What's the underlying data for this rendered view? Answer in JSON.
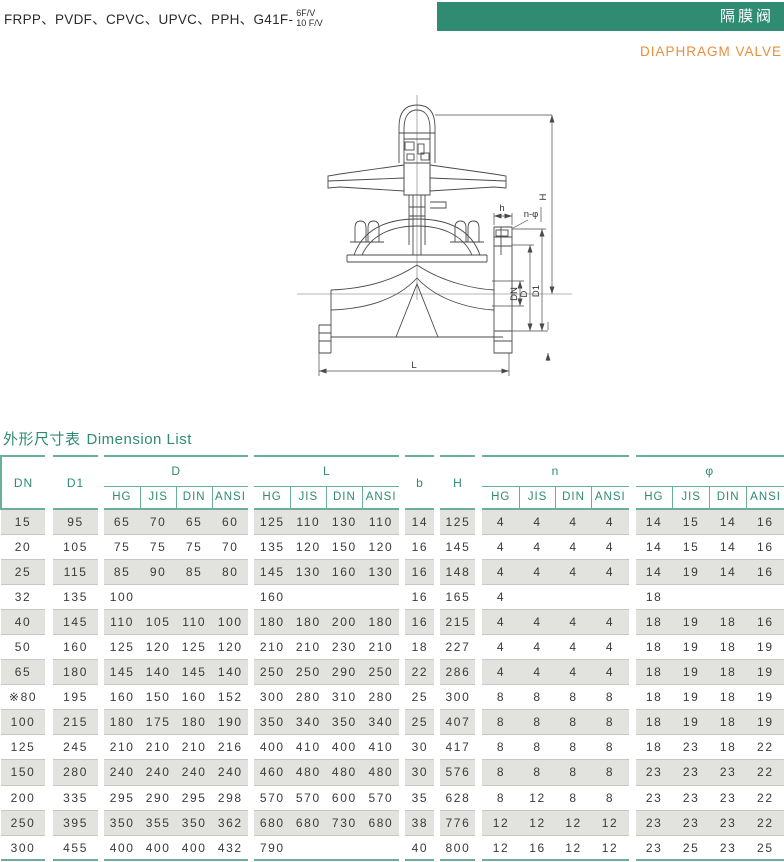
{
  "header": {
    "materials": "FRPP、PVDF、CPVC、UPVC、PPH、G41F-",
    "model_top": "6F/V",
    "model_bottom": "10 F/V",
    "banner_cn": "隔膜阀",
    "banner_en": "DIAPHRAGM VALVE"
  },
  "diagram": {
    "labels": {
      "H": "H",
      "h": "h",
      "n_phi": "n-φ",
      "DN": "DN",
      "D": "D",
      "D1": "D1",
      "L": "L"
    }
  },
  "section": {
    "title_cn": "外形尺寸表",
    "title_en": "Dimension List"
  },
  "table": {
    "standards": [
      "HG",
      "JIS",
      "DIN",
      "ANSI"
    ],
    "columns": {
      "dn": "DN",
      "d1": "D1",
      "d": "D",
      "l": "L",
      "b": "b",
      "h": "H",
      "n": "n",
      "phi": "φ"
    },
    "rows": [
      {
        "dn": "15",
        "d1": "95",
        "d": [
          "65",
          "70",
          "65",
          "60"
        ],
        "l": [
          "125",
          "110",
          "130",
          "110"
        ],
        "b": "14",
        "h": "125",
        "n": [
          "4",
          "4",
          "4",
          "4"
        ],
        "phi": [
          "14",
          "15",
          "14",
          "16"
        ]
      },
      {
        "dn": "20",
        "d1": "105",
        "d": [
          "75",
          "75",
          "75",
          "70"
        ],
        "l": [
          "135",
          "120",
          "150",
          "120"
        ],
        "b": "16",
        "h": "145",
        "n": [
          "4",
          "4",
          "4",
          "4"
        ],
        "phi": [
          "14",
          "15",
          "14",
          "16"
        ]
      },
      {
        "dn": "25",
        "d1": "115",
        "d": [
          "85",
          "90",
          "85",
          "80"
        ],
        "l": [
          "145",
          "130",
          "160",
          "130"
        ],
        "b": "16",
        "h": "148",
        "n": [
          "4",
          "4",
          "4",
          "4"
        ],
        "phi": [
          "14",
          "19",
          "14",
          "16"
        ]
      },
      {
        "dn": "32",
        "d1": "135",
        "d": [
          "100",
          "",
          "",
          ""
        ],
        "l": [
          "160",
          "",
          "",
          ""
        ],
        "b": "16",
        "h": "165",
        "n": [
          "4",
          "",
          "",
          ""
        ],
        "phi": [
          "18",
          "",
          "",
          ""
        ]
      },
      {
        "dn": "40",
        "d1": "145",
        "d": [
          "110",
          "105",
          "110",
          "100"
        ],
        "l": [
          "180",
          "180",
          "200",
          "180"
        ],
        "b": "16",
        "h": "215",
        "n": [
          "4",
          "4",
          "4",
          "4"
        ],
        "phi": [
          "18",
          "19",
          "18",
          "16"
        ]
      },
      {
        "dn": "50",
        "d1": "160",
        "d": [
          "125",
          "120",
          "125",
          "120"
        ],
        "l": [
          "210",
          "210",
          "230",
          "210"
        ],
        "b": "18",
        "h": "227",
        "n": [
          "4",
          "4",
          "4",
          "4"
        ],
        "phi": [
          "18",
          "19",
          "18",
          "19"
        ]
      },
      {
        "dn": "65",
        "d1": "180",
        "d": [
          "145",
          "140",
          "145",
          "140"
        ],
        "l": [
          "250",
          "250",
          "290",
          "250"
        ],
        "b": "22",
        "h": "286",
        "n": [
          "4",
          "4",
          "4",
          "4"
        ],
        "phi": [
          "18",
          "19",
          "18",
          "19"
        ]
      },
      {
        "dn": "※80",
        "d1": "195",
        "d": [
          "160",
          "150",
          "160",
          "152"
        ],
        "l": [
          "300",
          "280",
          "310",
          "280"
        ],
        "b": "25",
        "h": "300",
        "n": [
          "8",
          "8",
          "8",
          "8"
        ],
        "phi": [
          "18",
          "19",
          "18",
          "19"
        ]
      },
      {
        "dn": "100",
        "d1": "215",
        "d": [
          "180",
          "175",
          "180",
          "190"
        ],
        "l": [
          "350",
          "340",
          "350",
          "340"
        ],
        "b": "25",
        "h": "407",
        "n": [
          "8",
          "8",
          "8",
          "8"
        ],
        "phi": [
          "18",
          "19",
          "18",
          "19"
        ]
      },
      {
        "dn": "125",
        "d1": "245",
        "d": [
          "210",
          "210",
          "210",
          "216"
        ],
        "l": [
          "400",
          "410",
          "400",
          "410"
        ],
        "b": "30",
        "h": "417",
        "n": [
          "8",
          "8",
          "8",
          "8"
        ],
        "phi": [
          "18",
          "23",
          "18",
          "22"
        ]
      },
      {
        "dn": "150",
        "d1": "280",
        "d": [
          "240",
          "240",
          "240",
          "240"
        ],
        "l": [
          "460",
          "480",
          "480",
          "480"
        ],
        "b": "30",
        "h": "576",
        "n": [
          "8",
          "8",
          "8",
          "8"
        ],
        "phi": [
          "23",
          "23",
          "23",
          "22"
        ]
      },
      {
        "dn": "200",
        "d1": "335",
        "d": [
          "295",
          "290",
          "295",
          "298"
        ],
        "l": [
          "570",
          "570",
          "600",
          "570"
        ],
        "b": "35",
        "h": "628",
        "n": [
          "8",
          "12",
          "8",
          "8"
        ],
        "phi": [
          "23",
          "23",
          "23",
          "22"
        ]
      },
      {
        "dn": "250",
        "d1": "395",
        "d": [
          "350",
          "355",
          "350",
          "362"
        ],
        "l": [
          "680",
          "680",
          "730",
          "680"
        ],
        "b": "38",
        "h": "776",
        "n": [
          "12",
          "12",
          "12",
          "12"
        ],
        "phi": [
          "23",
          "23",
          "23",
          "22"
        ]
      },
      {
        "dn": "300",
        "d1": "455",
        "d": [
          "400",
          "400",
          "400",
          "432"
        ],
        "l": [
          "790",
          "",
          "",
          ""
        ],
        "b": "40",
        "h": "800",
        "n": [
          "12",
          "16",
          "12",
          "12"
        ],
        "phi": [
          "23",
          "25",
          "23",
          "25"
        ]
      }
    ]
  },
  "colors": {
    "accent_green": "#2F8B72",
    "accent_orange": "#E78F3D",
    "line_teal": "#6BAE9B",
    "row_gray": "#E2E2DF"
  }
}
